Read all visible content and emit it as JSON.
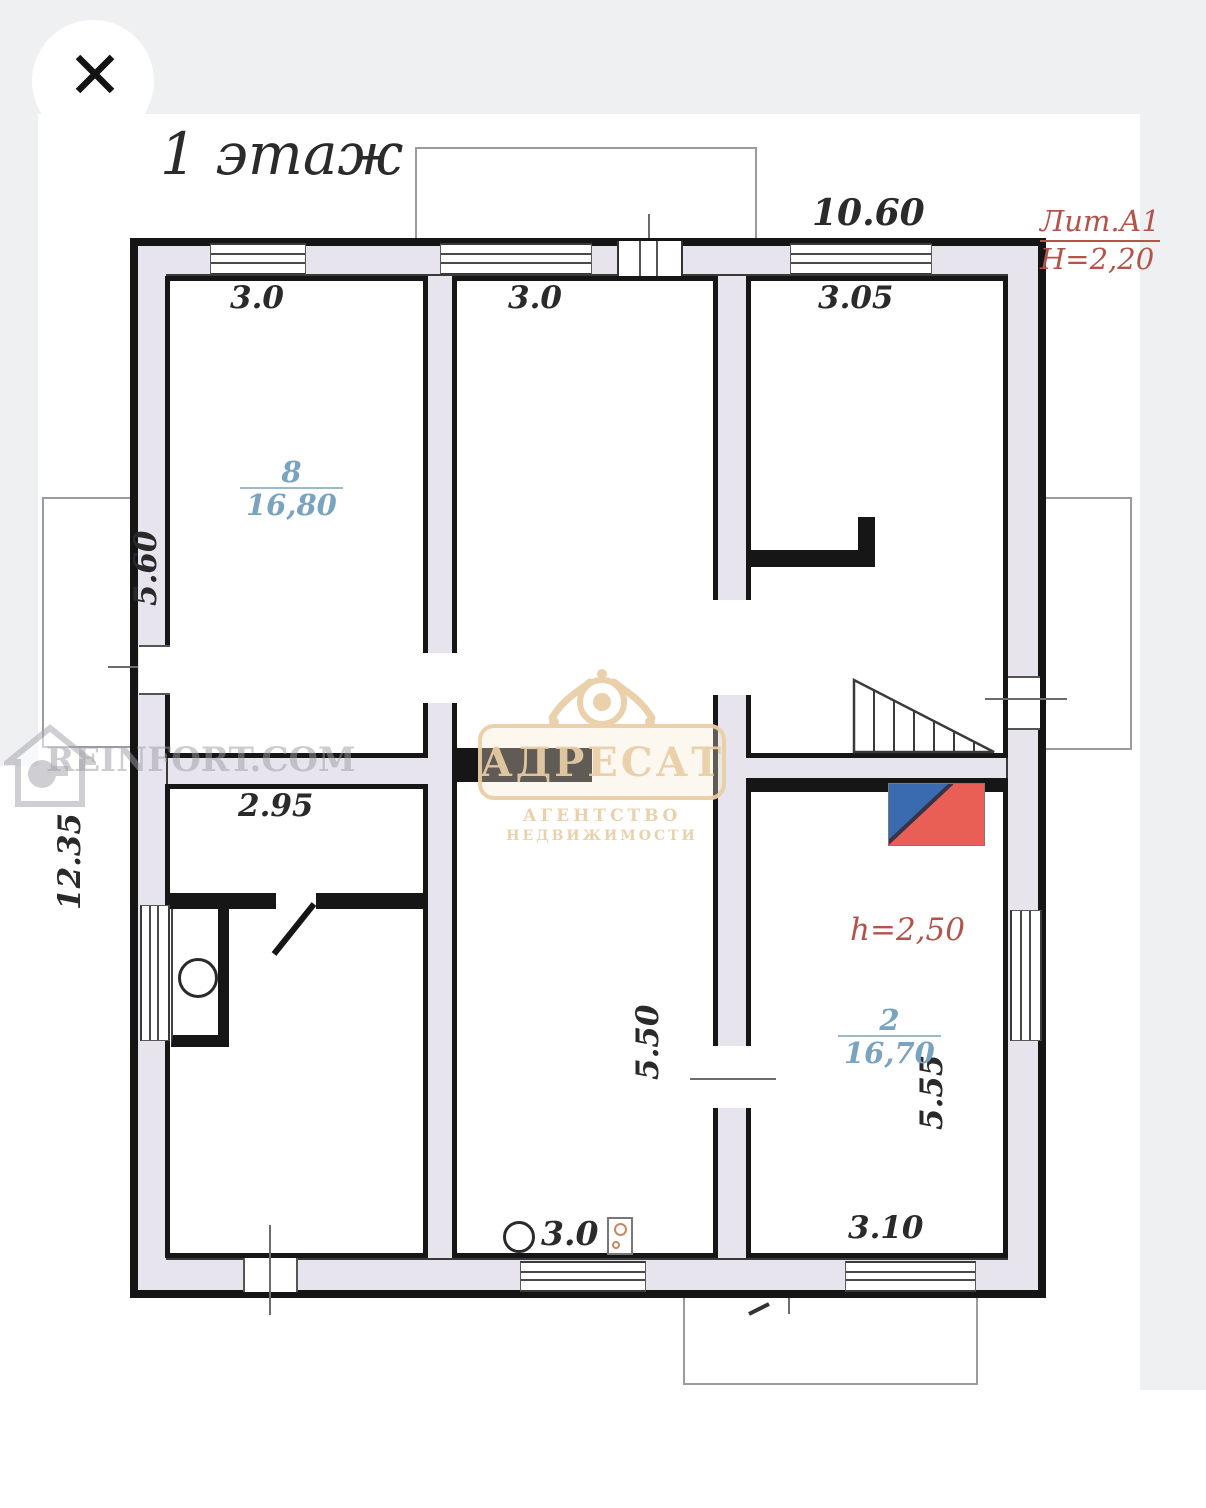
{
  "viewer": {
    "close_icon": "✕"
  },
  "plan": {
    "title": "1 этаж",
    "building": {
      "lit_label": "Лит.А1",
      "height_label": "Н=2,20"
    },
    "dimensions": {
      "top_width": "10.60",
      "room8_width": "3.0",
      "hall_width": "3.0",
      "top_right_width": "3.05",
      "room8_height": "5.60",
      "left_total_height": "12.35",
      "bottom_left_width": "2.95",
      "kitchen_height": "5.50",
      "kitchen_width": "3.0",
      "room2_height": "5.55",
      "room2_width": "3.10",
      "room2_ceiling_height": "h=2,50"
    },
    "rooms": [
      {
        "number": "8",
        "area": "16,80"
      },
      {
        "number": "2",
        "area": "16,70"
      }
    ]
  },
  "watermarks": {
    "agency": {
      "name": "АДРЕСАТ",
      "line1": "АГЕНТСТВО",
      "line2": "НЕДВИЖИМОСТИ"
    },
    "site": "REINFORT.COM"
  },
  "colors": {
    "annotation_red": "#b5524a",
    "room_label_blue": "#7aa3bf",
    "wall_black": "#161616",
    "wall_band": "#e7e4ee",
    "watermark_beige": "#e9cfa8",
    "flag_blue": "#3a6ab0",
    "flag_red": "#e95f55",
    "viewer_band_gray": "#eff0f2"
  }
}
